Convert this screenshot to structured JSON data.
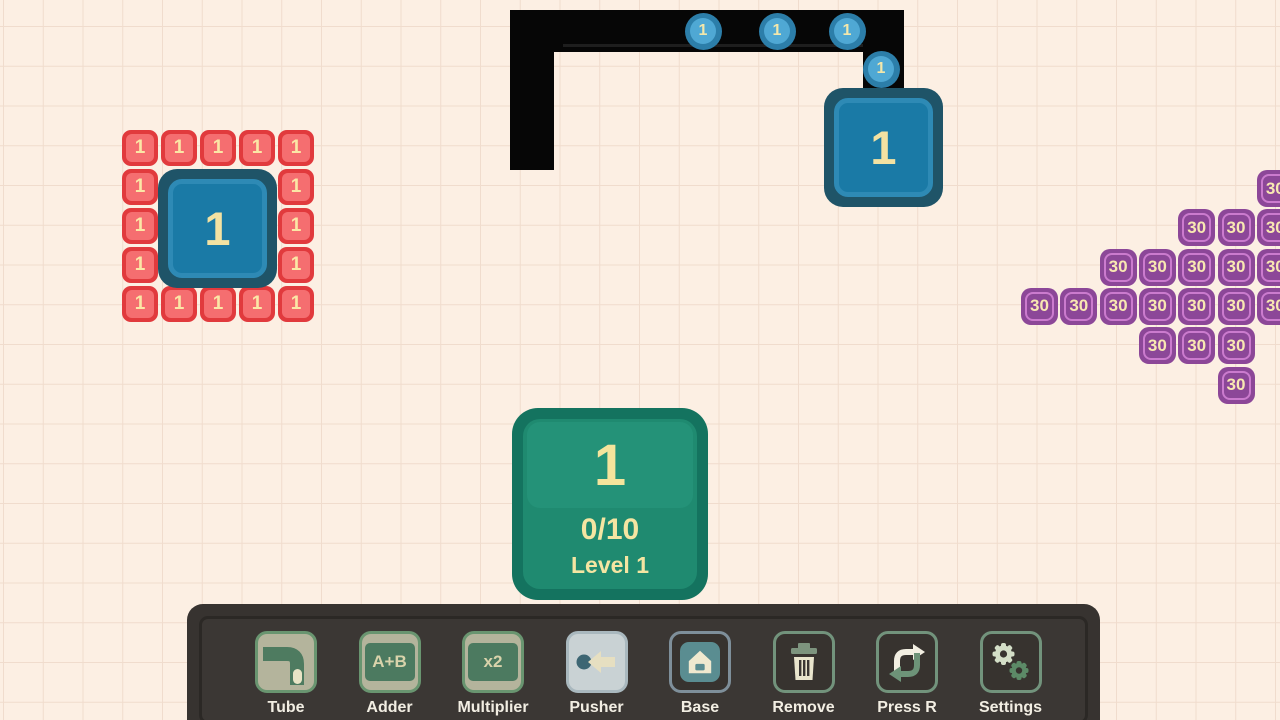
{
  "colors": {
    "background": "#fcefe3",
    "grid_line": "#f0dccd",
    "tube_black": "#060606",
    "orb_blue": "#4fa8d4",
    "item_red": "#e13a3d",
    "item_purple": "#8c4798",
    "base_blue": "#1a7aa6",
    "goal_green": "#1f8a70",
    "toolbar_gray": "#373330",
    "number_cream": "#f5e6a6"
  },
  "board": {
    "tube_segments": [
      {
        "x": 510,
        "y": 10,
        "w": 44,
        "h": 160
      },
      {
        "x": 510,
        "y": 10,
        "w": 394,
        "h": 42
      },
      {
        "x": 863,
        "y": 45,
        "w": 41,
        "h": 45
      }
    ],
    "tube_seam": {
      "x": 563,
      "y": 44,
      "w": 300,
      "h": 3
    },
    "orbs": {
      "value": "1",
      "radius": 18.5,
      "positions": [
        {
          "x": 703,
          "y": 31
        },
        {
          "x": 777,
          "y": 31
        },
        {
          "x": 847,
          "y": 31
        },
        {
          "x": 881,
          "y": 69
        }
      ]
    },
    "red_cluster": {
      "value": "1",
      "origin_x": 122,
      "origin_y": 130,
      "step": 39,
      "size": 36,
      "cells": [
        [
          0,
          0
        ],
        [
          0,
          1
        ],
        [
          0,
          2
        ],
        [
          0,
          3
        ],
        [
          0,
          4
        ],
        [
          1,
          0
        ],
        [
          1,
          4
        ],
        [
          2,
          0
        ],
        [
          2,
          4
        ],
        [
          3,
          0
        ],
        [
          3,
          4
        ],
        [
          4,
          0
        ],
        [
          4,
          1
        ],
        [
          4,
          2
        ],
        [
          4,
          3
        ],
        [
          4,
          4
        ]
      ]
    },
    "purple_cluster": {
      "value": "30",
      "origin_x": 1021,
      "origin_y": 170,
      "step": 39.3,
      "size": 37,
      "cells": [
        [
          0,
          6
        ],
        [
          1,
          4
        ],
        [
          1,
          5
        ],
        [
          1,
          6
        ],
        [
          2,
          2
        ],
        [
          2,
          3
        ],
        [
          2,
          4
        ],
        [
          2,
          5
        ],
        [
          2,
          6
        ],
        [
          3,
          0
        ],
        [
          3,
          1
        ],
        [
          3,
          2
        ],
        [
          3,
          3
        ],
        [
          3,
          4
        ],
        [
          3,
          5
        ],
        [
          3,
          6
        ],
        [
          4,
          3
        ],
        [
          4,
          4
        ],
        [
          4,
          5
        ],
        [
          5,
          5
        ]
      ]
    },
    "bases": [
      {
        "x": 158,
        "y": 169,
        "size": 119,
        "value": "1"
      },
      {
        "x": 824,
        "y": 88,
        "size": 119,
        "value": "1"
      }
    ],
    "goal": {
      "value": "1",
      "progress": "0/10",
      "level": "Level 1"
    }
  },
  "toolbar": {
    "items": [
      {
        "slug": "tube",
        "label": "Tube",
        "icon": "tube-icon",
        "style": "beige"
      },
      {
        "slug": "adder",
        "label": "Adder",
        "icon": "adder-icon",
        "style": "beige",
        "icon_text": "A+B"
      },
      {
        "slug": "multiplier",
        "label": "Multiplier",
        "icon": "multiplier-icon",
        "style": "beige",
        "icon_text": "x2"
      },
      {
        "slug": "pusher",
        "label": "Pusher",
        "icon": "pusher-icon",
        "style": "light"
      },
      {
        "slug": "base",
        "label": "Base",
        "icon": "base-icon",
        "style": "darkblue"
      },
      {
        "slug": "remove",
        "label": "Remove",
        "icon": "trash-icon",
        "style": "darkgreen"
      },
      {
        "slug": "press-r",
        "label": "Press R",
        "icon": "rotate-icon",
        "style": "darkgreen"
      },
      {
        "slug": "settings",
        "label": "Settings",
        "icon": "settings-icon",
        "style": "darkgreen"
      }
    ]
  }
}
